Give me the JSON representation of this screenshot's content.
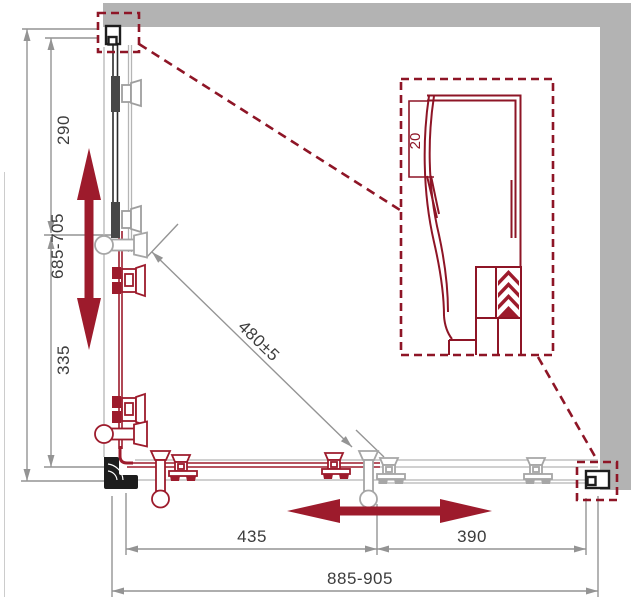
{
  "dims": {
    "overall_height": "685-705",
    "upper_section": "290",
    "lower_section": "335",
    "diagonal": "480±5",
    "profile": "20",
    "door_left": "435",
    "door_right": "390",
    "overall_width": "885-905"
  },
  "colors": {
    "wall_gray": "#b3b3b3",
    "dimension_line": "#949494",
    "dimension_text": "#3c3c3c",
    "hardware_red": "#9d1b2c",
    "callout_dashed_red": "#8e1526",
    "hardware_gray": "#a6a6a6",
    "profile_black": "#1d1d1d"
  }
}
